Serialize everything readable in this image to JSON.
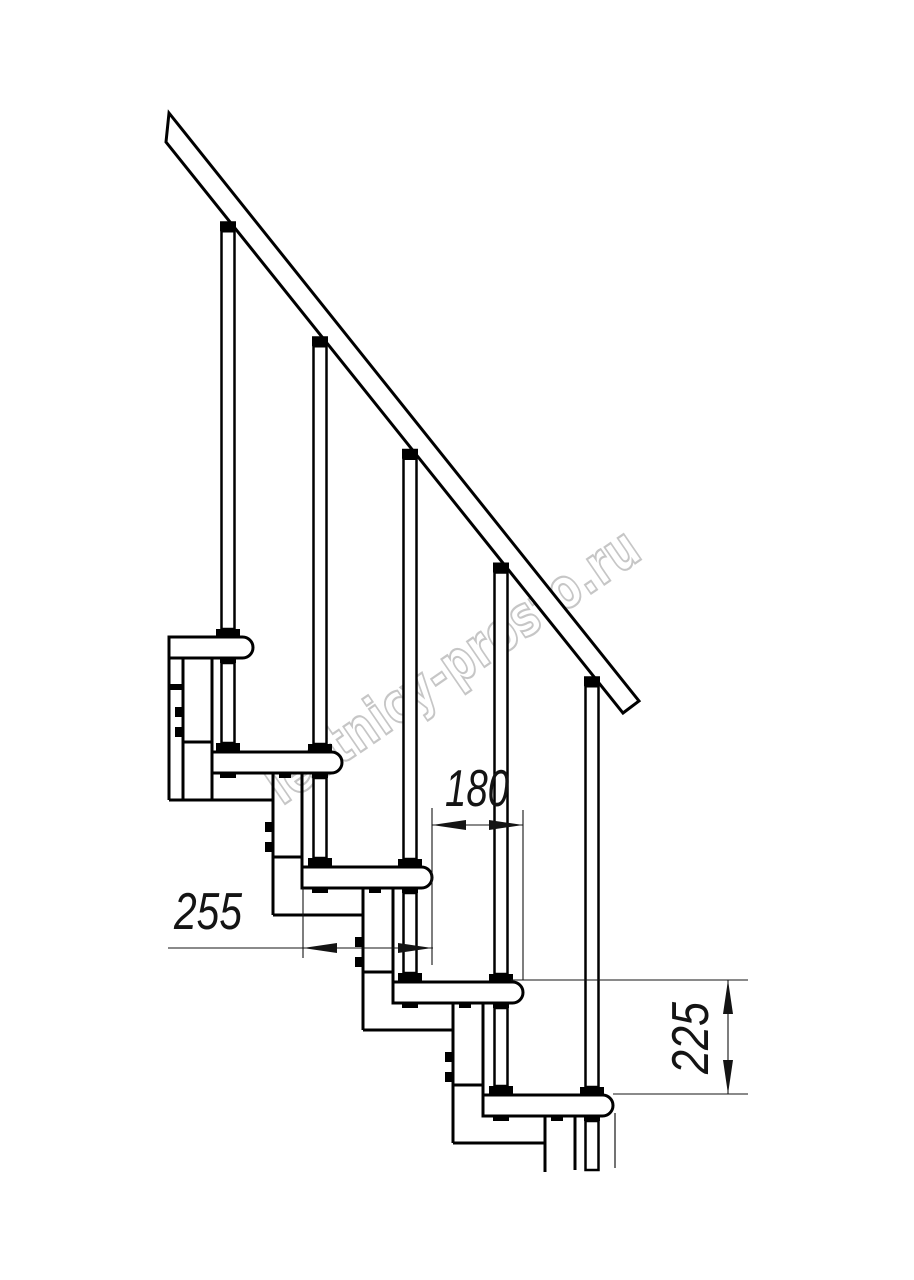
{
  "watermark": {
    "text": "lestnicy-prosto.ru",
    "color": "#c6c6c6"
  },
  "dimensions": {
    "step_run": {
      "value": "180",
      "orientation": "horizontal"
    },
    "tread_depth": {
      "value": "255",
      "orientation": "horizontal"
    },
    "step_rise": {
      "value": "225",
      "orientation": "vertical"
    }
  },
  "drawing": {
    "subject": "modular staircase side view",
    "line_color": "#000000",
    "dimension_color": "#141414",
    "background": "#ffffff",
    "tread_count": 5,
    "baluster_count": 5
  }
}
